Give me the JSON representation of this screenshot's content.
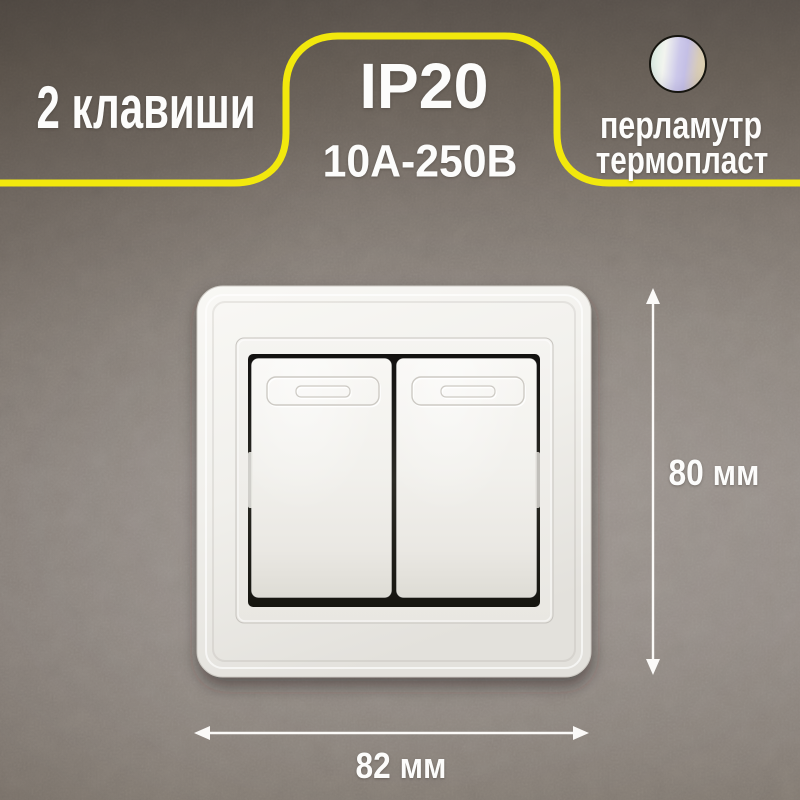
{
  "badges": {
    "keys": "2 клавиши",
    "ip": "IP20",
    "voltage": "10А-250В",
    "material_color": "перламутр",
    "material_type": "термопласт"
  },
  "dimensions": {
    "height": "80 мм",
    "width": "82 мм"
  },
  "swatch": {
    "name": "pearl-gradient-swatch",
    "colors": [
      "#d9efe0",
      "#f2f4ef",
      "#c7c2e8",
      "#e9dcae"
    ]
  },
  "colors": {
    "accent_yellow": "#f2e80d",
    "wall_background": "#87807a",
    "text": "#fcfcfb",
    "switch_body": "#f1f0ec"
  }
}
